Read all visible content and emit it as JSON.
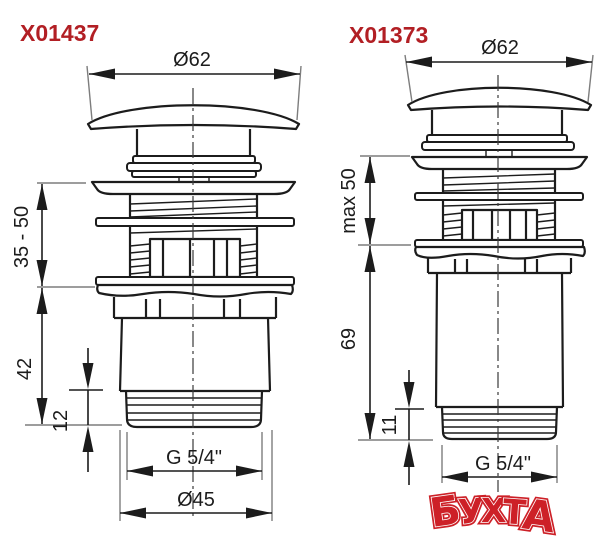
{
  "colors": {
    "label_red": "#b21f24",
    "line": "#1c1c1c",
    "extension_line_gray": "#7d7d7d",
    "watermark_red": "#cd2027",
    "background": "#ffffff"
  },
  "figures": [
    {
      "label": "X01437",
      "dimensions": {
        "top_diameter": "Ø62",
        "height_range": "35 - 50",
        "body_height": "42",
        "thread_length": "12",
        "thread_size": "G 5/4\"",
        "flange_diameter": "Ø45"
      }
    },
    {
      "label": "X01373",
      "dimensions": {
        "top_diameter": "Ø62",
        "height_max": "max 50",
        "body_height": "69",
        "thread_length": "11",
        "thread_size": "G 5/4\""
      }
    }
  ],
  "watermark": {
    "text": "БУХТА",
    "letters": [
      "Б",
      "У",
      "Х",
      "Т",
      "А"
    ]
  }
}
